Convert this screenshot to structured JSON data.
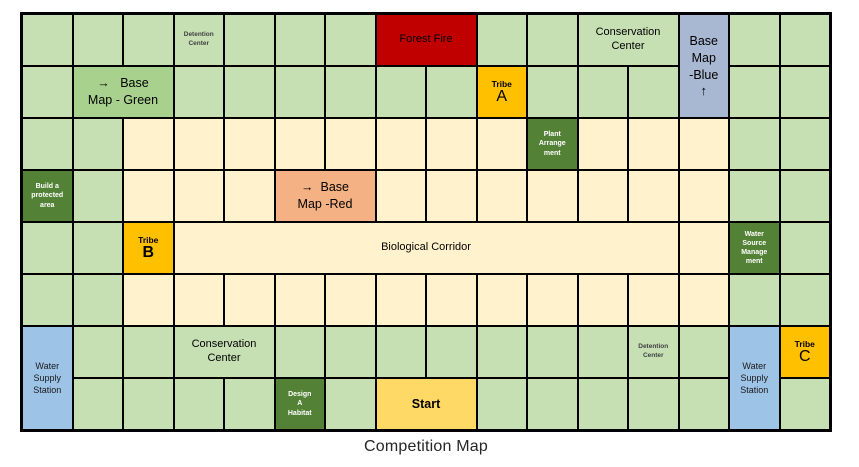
{
  "title": "Competition Map",
  "colors": {
    "light_green": "#c6e0b4",
    "medium_green": "#a9d18e",
    "cream": "#fff2cc",
    "dark_green": "#538135",
    "red": "#c00000",
    "orange": "#f4b183",
    "amber": "#ffc000",
    "yellow": "#ffd966",
    "blue": "#9dc3e6",
    "blue_gray": "#a9b8d2",
    "grid_line": "#000000"
  },
  "grid": {
    "cols": 16,
    "rows": 8,
    "fill_codes": {
      "g": "light_green",
      "c": "cream"
    },
    "base": [
      "gggggggggggggggg",
      "gggggggggggggggg",
      "ggccccccccccccgg",
      "ggccccccccccccgg",
      "ggccccccccccccgg",
      "ggccccccccccccgg",
      "gggggggggggggggg",
      "gggggggggggggggg"
    ],
    "cells": [
      {
        "name": "cell-detention-center-top",
        "row": 1,
        "col": 4,
        "fill": "light_green",
        "style": "small-label",
        "lines": [
          "Detention",
          "Center"
        ]
      },
      {
        "name": "cell-forest-fire",
        "row": 1,
        "col": 8,
        "col_span": 2,
        "fill": "red",
        "style": "med-label",
        "lines": [
          "Forest Fire"
        ]
      },
      {
        "name": "cell-conservation-center-top",
        "row": 1,
        "col": 12,
        "col_span": 2,
        "fill": "light_green",
        "style": "med-label",
        "lines": [
          "Conservation",
          "Center"
        ]
      },
      {
        "name": "cell-base-map-blue",
        "row": 1,
        "col": 14,
        "row_span": 2,
        "fill": "blue_gray",
        "style": "map-label blue-portal",
        "lines": [
          "Base",
          "Map",
          "-Blue",
          "↑"
        ]
      },
      {
        "name": "cell-base-map-green",
        "row": 2,
        "col": 2,
        "col_span": 2,
        "fill": "medium_green",
        "style": "map-label",
        "lines": [
          "→   Base",
          "Map - Green"
        ]
      },
      {
        "name": "cell-tribe-a",
        "row": 2,
        "col": 10,
        "fill": "amber",
        "style": "tribe",
        "lines": [
          "Tribe",
          "A"
        ]
      },
      {
        "name": "cell-plant-arrangement",
        "row": 3,
        "col": 11,
        "fill": "dark_green",
        "style": "task",
        "lines": [
          "Plant",
          "Arrange",
          "ment"
        ]
      },
      {
        "name": "cell-build-protected-area",
        "row": 4,
        "col": 1,
        "fill": "dark_green",
        "style": "task",
        "lines": [
          "Build a",
          "protected",
          "area"
        ]
      },
      {
        "name": "cell-base-map-red",
        "row": 4,
        "col": 6,
        "col_span": 2,
        "fill": "orange",
        "style": "map-label",
        "lines": [
          "→  Base",
          "Map -Red"
        ]
      },
      {
        "name": "cell-tribe-b",
        "row": 5,
        "col": 3,
        "fill": "amber",
        "style": "tribe bold-letter",
        "lines": [
          "Tribe",
          "B"
        ]
      },
      {
        "name": "cell-biological-corridor",
        "row": 5,
        "col": 4,
        "col_span": 10,
        "fill": "cream",
        "style": "med-label",
        "lines": [
          "Biological Corridor"
        ]
      },
      {
        "name": "cell-water-source-management",
        "row": 5,
        "col": 15,
        "fill": "dark_green",
        "style": "task",
        "lines": [
          "Water",
          "Source",
          "Manage",
          "ment"
        ]
      },
      {
        "name": "cell-water-supply-station-left",
        "row": 7,
        "col": 1,
        "row_span": 2,
        "fill": "blue",
        "style": "wss",
        "lines": [
          "Water",
          "Supply",
          "Station"
        ]
      },
      {
        "name": "cell-conservation-center-bottom",
        "row": 7,
        "col": 4,
        "col_span": 2,
        "fill": "light_green",
        "style": "med-label",
        "lines": [
          "Conservation",
          "Center"
        ]
      },
      {
        "name": "cell-detention-center-bottom",
        "row": 7,
        "col": 13,
        "fill": "light_green",
        "style": "small-label",
        "lines": [
          "Detention",
          "Center"
        ]
      },
      {
        "name": "cell-water-supply-station-right",
        "row": 7,
        "col": 15,
        "row_span": 2,
        "fill": "blue",
        "style": "wss",
        "lines": [
          "Water",
          "Supply",
          "Station"
        ]
      },
      {
        "name": "cell-tribe-c",
        "row": 7,
        "col": 16,
        "fill": "amber",
        "style": "tribe",
        "lines": [
          "Tribe",
          "C"
        ]
      },
      {
        "name": "cell-design-a-habitat",
        "row": 8,
        "col": 6,
        "fill": "dark_green",
        "style": "task",
        "lines": [
          "Design",
          "A",
          "Habitat"
        ]
      },
      {
        "name": "cell-start",
        "row": 8,
        "col": 8,
        "col_span": 2,
        "fill": "yellow",
        "style": "start-label",
        "lines": [
          "Start"
        ]
      }
    ]
  }
}
